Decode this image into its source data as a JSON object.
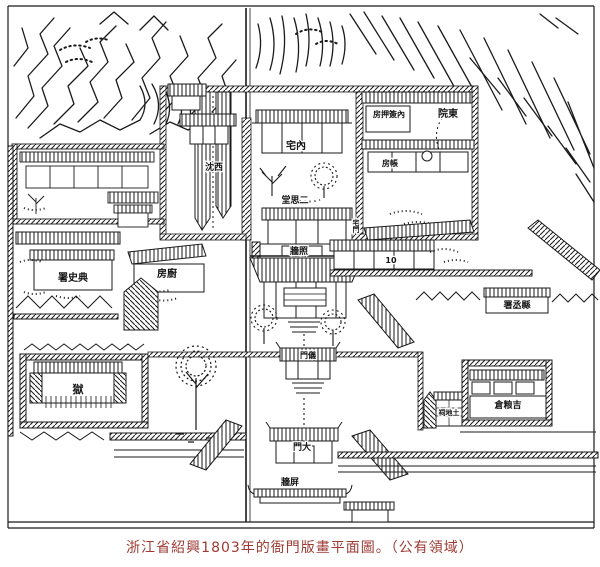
{
  "caption": {
    "text": "浙江省紹興1803年的衙門版畫平面圖。（公有領域）",
    "color": "#9e3a32"
  },
  "map": {
    "description": "1803 woodblock-print floor plan of a yamen in Shaoxing, Zhejiang",
    "ink_color": "#1a1a1a",
    "paper_color": "#ffffff",
    "labels": [
      {
        "id": "west-corridor",
        "text": "沈西",
        "reading": "西沈",
        "x": 214,
        "y": 170,
        "size": 9
      },
      {
        "id": "inner-residence-hall",
        "text": "宅內",
        "reading": "內宅",
        "x": 296,
        "y": 149,
        "size": 10
      },
      {
        "id": "inner-signing-office",
        "text": "房押簽內",
        "reading": "內簽押房",
        "x": 389,
        "y": 117,
        "size": 8
      },
      {
        "id": "east-courtyard",
        "text": "院東",
        "reading": "東院",
        "x": 448,
        "y": 117,
        "size": 10
      },
      {
        "id": "accounts-room",
        "text": "房帳",
        "reading": "帳房",
        "x": 390,
        "y": 166,
        "size": 8
      },
      {
        "id": "second-hall",
        "text": "堂思二",
        "reading": "二思堂",
        "x": 295,
        "y": 203,
        "size": 9
      },
      {
        "id": "residence-gate",
        "text": "宅門",
        "reading": "宅門",
        "x": 356,
        "y": 226,
        "size": 7,
        "vertical": true
      },
      {
        "id": "inner-screen-wall",
        "text": "牆照",
        "reading": "照牆",
        "x": 299,
        "y": 254,
        "size": 9
      },
      {
        "id": "kitchen",
        "text": "房廚",
        "reading": "廚房",
        "x": 167,
        "y": 277,
        "size": 10
      },
      {
        "id": "jail-warden-office",
        "text": "署史典",
        "reading": "典史署",
        "x": 73,
        "y": 281,
        "size": 10
      },
      {
        "id": "clerks-row-mark",
        "text": "10",
        "reading": "10",
        "x": 391,
        "y": 263,
        "size": 8
      },
      {
        "id": "deputy-magistrate-office",
        "text": "署丞縣",
        "reading": "縣丞署",
        "x": 517,
        "y": 308,
        "size": 9
      },
      {
        "id": "ceremonial-gate",
        "text": "門儀",
        "reading": "儀門",
        "x": 308,
        "y": 358,
        "size": 8
      },
      {
        "id": "prison",
        "text": "獄",
        "reading": "獄",
        "x": 78,
        "y": 393,
        "size": 11
      },
      {
        "id": "earth-god-shrine",
        "text": "祠地土",
        "reading": "土地祠",
        "x": 449,
        "y": 415,
        "size": 7
      },
      {
        "id": "granary",
        "text": "倉粮吉",
        "reading": "吉粮倉",
        "x": 508,
        "y": 408,
        "size": 9
      },
      {
        "id": "main-gate",
        "text": "門大",
        "reading": "大門",
        "x": 302,
        "y": 450,
        "size": 9
      },
      {
        "id": "outer-screen-wall",
        "text": "牆屏",
        "reading": "屏牆",
        "x": 290,
        "y": 485,
        "size": 9
      }
    ]
  }
}
